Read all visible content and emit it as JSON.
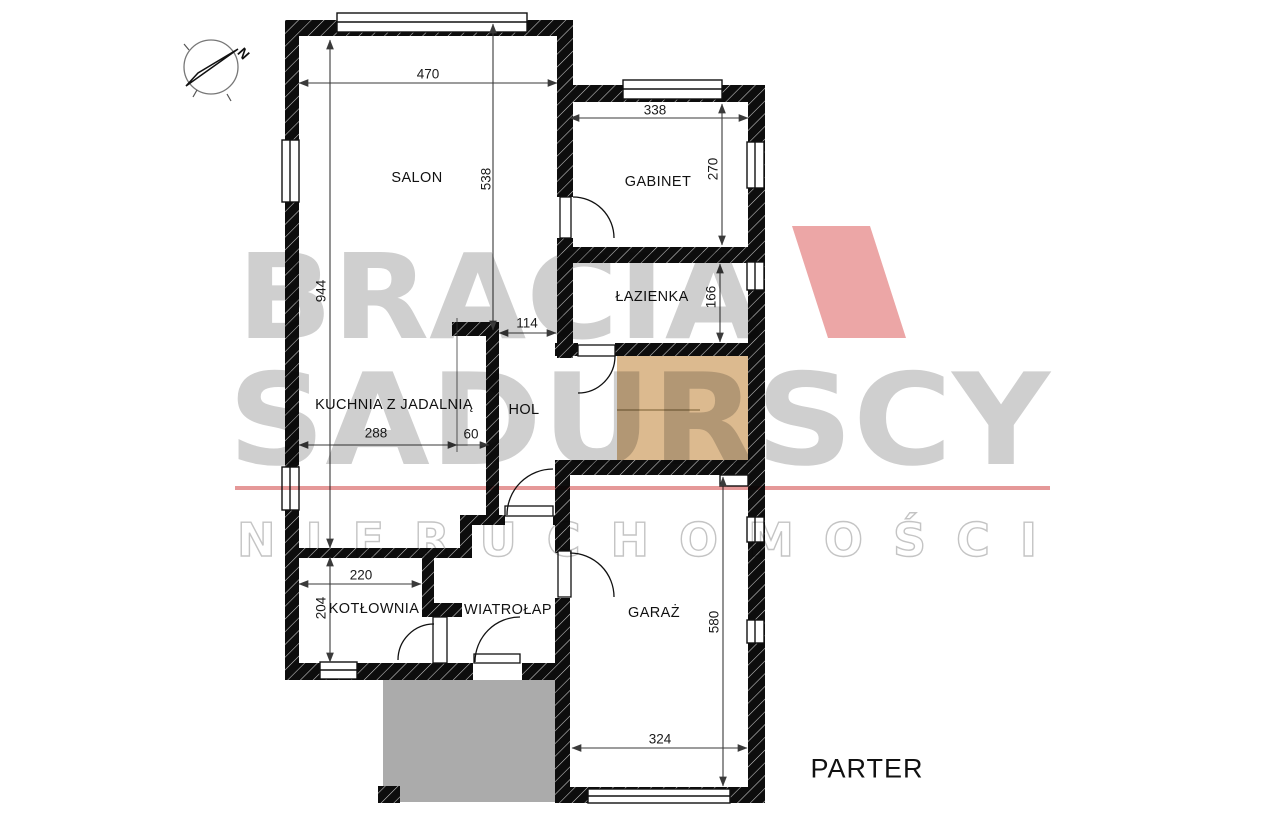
{
  "plan": {
    "floor_label": "PARTER",
    "compass_label": "N",
    "rooms": [
      {
        "id": "salon",
        "label": "SALON",
        "x": 417,
        "y": 178
      },
      {
        "id": "gabinet",
        "label": "GABINET",
        "x": 658,
        "y": 182
      },
      {
        "id": "lazienka",
        "label": "ŁAZIENKA",
        "x": 652,
        "y": 297
      },
      {
        "id": "kuchnia",
        "label": "KUCHNIA Z JADALNIĄ",
        "x": 394,
        "y": 405
      },
      {
        "id": "hol",
        "label": "HOL",
        "x": 524,
        "y": 410
      },
      {
        "id": "kotlownia",
        "label": "KOTŁOWNIA",
        "x": 374,
        "y": 609
      },
      {
        "id": "wiatrolap",
        "label": "WIATROŁAP",
        "x": 508,
        "y": 610
      },
      {
        "id": "garaz",
        "label": "GARAŻ",
        "x": 654,
        "y": 613
      }
    ],
    "dimensions_cm": [
      {
        "value": "470",
        "x": 428,
        "y": 74,
        "orient": "h"
      },
      {
        "value": "538",
        "x": 486,
        "y": 179,
        "orient": "v"
      },
      {
        "value": "944",
        "x": 321,
        "y": 291,
        "orient": "v"
      },
      {
        "value": "338",
        "x": 655,
        "y": 110,
        "orient": "h"
      },
      {
        "value": "270",
        "x": 713,
        "y": 169,
        "orient": "v"
      },
      {
        "value": "166",
        "x": 711,
        "y": 297,
        "orient": "v"
      },
      {
        "value": "114",
        "x": 527,
        "y": 323,
        "orient": "h"
      },
      {
        "value": "288",
        "x": 376,
        "y": 433,
        "orient": "h"
      },
      {
        "value": "60",
        "x": 471,
        "y": 434,
        "orient": "h"
      },
      {
        "value": "220",
        "x": 361,
        "y": 575,
        "orient": "h"
      },
      {
        "value": "204",
        "x": 321,
        "y": 608,
        "orient": "v"
      },
      {
        "value": "580",
        "x": 714,
        "y": 622,
        "orient": "v"
      },
      {
        "value": "324",
        "x": 660,
        "y": 739,
        "orient": "h"
      }
    ]
  },
  "watermark": {
    "line1": "BRACIA",
    "line2": "SADURSCY",
    "line3": "NIERUCHOMOŚCI"
  },
  "colors": {
    "wall": "#0d0d0d",
    "stairs_fill": "#dcba8f",
    "stairs_border": "#c9a87c",
    "stairs_line": "#a98b60",
    "porch_fill": "#ababab",
    "watermark_text": "#cfcfcf",
    "watermark_red_line": "#e59898",
    "logo_red": "#eca6a6",
    "dimension_line": "#3a3a3a"
  }
}
